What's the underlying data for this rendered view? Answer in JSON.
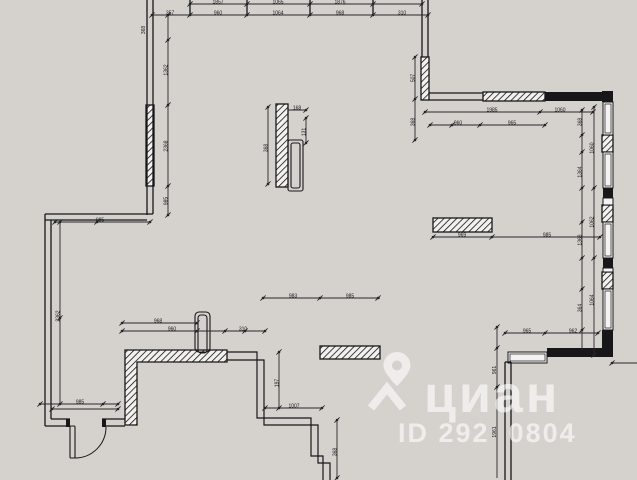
{
  "canvas": {
    "width": 637,
    "height": 480,
    "background": "#d5d2cd",
    "ink": "#17171a",
    "dim_color": "#26262a",
    "hatch_fill": "#f2f1ee",
    "window_fill": "#f4f3f1"
  },
  "watermark": {
    "logo_text": "циан",
    "id_text": "ID 292  0804",
    "color": "#ffffff",
    "pin_icon": "location-pin"
  },
  "plan": {
    "hatch_rects": [
      {
        "x": 146,
        "y": 105,
        "w": 8,
        "h": 81
      },
      {
        "x": 421,
        "y": 57,
        "w": 8,
        "h": 43
      },
      {
        "x": 483,
        "y": 92,
        "w": 62,
        "h": 9
      },
      {
        "x": 602,
        "y": 135,
        "w": 11,
        "h": 17
      },
      {
        "x": 602,
        "y": 205,
        "w": 11,
        "h": 17
      },
      {
        "x": 602,
        "y": 272,
        "w": 11,
        "h": 17
      },
      {
        "x": 276,
        "y": 104,
        "w": 12,
        "h": 83
      },
      {
        "x": 433,
        "y": 218,
        "w": 59,
        "h": 14
      },
      {
        "x": 320,
        "y": 346,
        "w": 60,
        "h": 13
      }
    ],
    "hatch_polygons": [
      {
        "pts": [
          [
            125,
            350
          ],
          [
            227,
            350
          ],
          [
            227,
            362
          ],
          [
            137,
            362
          ],
          [
            137,
            425
          ],
          [
            125,
            425
          ]
        ]
      }
    ],
    "solid_rects": [
      {
        "x": 545,
        "y": 92,
        "w": 62,
        "h": 9
      },
      {
        "x": 602,
        "y": 91,
        "w": 11,
        "h": 11
      },
      {
        "x": 603,
        "y": 188,
        "w": 10,
        "h": 10
      },
      {
        "x": 603,
        "y": 258,
        "w": 10,
        "h": 10
      },
      {
        "x": 602,
        "y": 330,
        "w": 11,
        "h": 27
      },
      {
        "x": 547,
        "y": 348,
        "w": 66,
        "h": 9
      },
      {
        "x": 66,
        "y": 419,
        "w": 4,
        "h": 8
      },
      {
        "x": 102,
        "y": 419,
        "w": 4,
        "h": 8
      }
    ],
    "window_rects": [
      {
        "x": 603,
        "y": 102,
        "w": 10,
        "h": 33
      },
      {
        "x": 603,
        "y": 152,
        "w": 10,
        "h": 36
      },
      {
        "x": 603,
        "y": 198,
        "w": 10,
        "h": 7
      },
      {
        "x": 603,
        "y": 222,
        "w": 10,
        "h": 36
      },
      {
        "x": 603,
        "y": 268,
        "w": 10,
        "h": 4
      },
      {
        "x": 603,
        "y": 289,
        "w": 10,
        "h": 41
      },
      {
        "x": 508,
        "y": 352,
        "w": 39,
        "h": 11
      }
    ],
    "lines": [
      [
        147,
        0,
        147,
        215
      ],
      [
        153,
        0,
        153,
        214
      ],
      [
        45,
        214,
        153,
        214
      ],
      [
        45,
        220,
        147,
        220
      ],
      [
        45,
        214,
        45,
        426
      ],
      [
        51,
        220,
        51,
        419
      ],
      [
        45,
        426,
        70,
        426
      ],
      [
        51,
        419,
        70,
        419
      ],
      [
        102,
        419,
        125,
        419
      ],
      [
        102,
        426,
        125,
        426
      ],
      [
        422,
        0,
        422,
        57
      ],
      [
        428,
        0,
        428,
        57
      ],
      [
        429,
        93,
        483,
        93
      ],
      [
        429,
        100,
        483,
        100
      ],
      [
        505,
        362,
        505,
        480
      ],
      [
        511,
        362,
        511,
        480
      ],
      [
        505,
        362,
        511,
        362
      ],
      [
        190,
        0,
        190,
        15
      ],
      [
        247,
        0,
        247,
        15
      ],
      [
        310,
        0,
        310,
        15
      ],
      [
        373,
        0,
        373,
        15
      ]
    ],
    "polylines": [
      {
        "pts": [
          [
            227,
            352
          ],
          [
            257,
            352
          ],
          [
            257,
            418
          ],
          [
            311,
            418
          ],
          [
            311,
            456
          ],
          [
            323,
            456
          ],
          [
            323,
            480
          ]
        ]
      },
      {
        "pts": [
          [
            227,
            360
          ],
          [
            264,
            360
          ],
          [
            264,
            425
          ],
          [
            318,
            425
          ],
          [
            318,
            463
          ],
          [
            330,
            463
          ],
          [
            330,
            480
          ]
        ]
      }
    ],
    "stroke_rects": [
      {
        "x": 195,
        "y": 312,
        "w": 15,
        "h": 40,
        "rx": 4,
        "name": "stub-wall"
      },
      {
        "x": 198,
        "y": 315,
        "w": 9,
        "h": 38,
        "rx": 3,
        "name": "stub-wall-inner"
      },
      {
        "x": 288,
        "y": 140,
        "w": 15,
        "h": 51,
        "rx": 2,
        "name": "duct-shaft"
      },
      {
        "x": 291,
        "y": 143,
        "w": 9,
        "h": 45,
        "rx": 2,
        "name": "duct-shaft-inner"
      },
      {
        "x": 70,
        "y": 426,
        "w": 5,
        "h": 32,
        "rx": 1,
        "name": "door-leaf"
      }
    ],
    "door_arc": {
      "d": "M 75 458 A 31 31 0 0 0 106 427"
    },
    "dim_lines": [
      {
        "x1": 190,
        "y1": 4,
        "x2": 422,
        "y2": 4,
        "ticks": [
          190,
          247,
          310,
          373,
          422
        ]
      },
      {
        "x1": 152,
        "y1": 15,
        "x2": 428,
        "y2": 15,
        "ticks": [
          152,
          190,
          247,
          310,
          373,
          428
        ]
      },
      {
        "x1": 168,
        "y1": 15,
        "x2": 168,
        "y2": 215,
        "ticks": [
          15,
          40,
          105,
          186,
          215
        ]
      },
      {
        "x1": 55,
        "y1": 222,
        "x2": 150,
        "y2": 222,
        "ticks": [
          55,
          97,
          150
        ]
      },
      {
        "x1": 60,
        "y1": 222,
        "x2": 60,
        "y2": 404,
        "ticks": [
          222,
          318,
          404
        ]
      },
      {
        "x1": 40,
        "y1": 404,
        "x2": 118,
        "y2": 404,
        "ticks": [
          40,
          103,
          118
        ]
      },
      {
        "x1": 52,
        "y1": 409,
        "x2": 118,
        "y2": 409,
        "ticks": [
          52,
          118
        ]
      },
      {
        "x1": 122,
        "y1": 323,
        "x2": 197,
        "y2": 323,
        "ticks": [
          122,
          197
        ]
      },
      {
        "x1": 122,
        "y1": 331,
        "x2": 265,
        "y2": 331,
        "ticks": [
          122,
          197,
          225,
          245,
          265
        ]
      },
      {
        "x1": 263,
        "y1": 298,
        "x2": 380,
        "y2": 298,
        "ticks": [
          263,
          320,
          378
        ]
      },
      {
        "x1": 433,
        "y1": 237,
        "x2": 600,
        "y2": 237,
        "ticks": [
          433,
          492,
          600
        ]
      },
      {
        "x1": 425,
        "y1": 112,
        "x2": 593,
        "y2": 112,
        "ticks": [
          425,
          540,
          593
        ]
      },
      {
        "x1": 430,
        "y1": 125,
        "x2": 545,
        "y2": 125,
        "ticks": [
          430,
          452,
          480,
          545
        ]
      },
      {
        "x1": 415,
        "y1": 57,
        "x2": 415,
        "y2": 140,
        "ticks": [
          57,
          99,
          140
        ]
      },
      {
        "x1": 582,
        "y1": 110,
        "x2": 582,
        "y2": 350,
        "ticks": [
          110,
          135,
          152,
          188,
          222,
          258,
          289,
          330
        ]
      },
      {
        "x1": 594,
        "y1": 107,
        "x2": 594,
        "y2": 355,
        "ticks": [
          107,
          188,
          258,
          355
        ]
      },
      {
        "x1": 505,
        "y1": 333,
        "x2": 598,
        "y2": 333,
        "ticks": [
          505,
          545,
          598
        ]
      },
      {
        "x1": 497,
        "y1": 327,
        "x2": 497,
        "y2": 478,
        "ticks": [
          327,
          348,
          387
        ]
      },
      {
        "x1": 612,
        "y1": 363,
        "x2": 637,
        "y2": 363,
        "ticks": [
          612
        ]
      },
      {
        "x1": 279,
        "y1": 352,
        "x2": 279,
        "y2": 408,
        "ticks": [
          352,
          408
        ]
      },
      {
        "x1": 265,
        "y1": 408,
        "x2": 322,
        "y2": 408,
        "ticks": [
          265,
          322
        ]
      },
      {
        "x1": 337,
        "y1": 420,
        "x2": 337,
        "y2": 478,
        "ticks": [
          420,
          478
        ]
      },
      {
        "x1": 268,
        "y1": 107,
        "x2": 268,
        "y2": 184,
        "ticks": [
          107,
          184
        ]
      },
      {
        "x1": 306,
        "y1": 118,
        "x2": 306,
        "y2": 143,
        "ticks": [
          118,
          143
        ]
      },
      {
        "x1": 288,
        "y1": 110,
        "x2": 306,
        "y2": 110,
        "ticks": [
          306
        ]
      }
    ],
    "dim_texts": [
      {
        "x": 218,
        "y": 2.5,
        "t": "1857"
      },
      {
        "x": 278,
        "y": 2.5,
        "t": "1065"
      },
      {
        "x": 340,
        "y": 2.5,
        "t": "1876"
      },
      {
        "x": 170,
        "y": 13.5,
        "t": "357"
      },
      {
        "x": 218,
        "y": 13.5,
        "t": "960"
      },
      {
        "x": 278,
        "y": 13.5,
        "t": "1064"
      },
      {
        "x": 340,
        "y": 13.5,
        "t": "968"
      },
      {
        "x": 402,
        "y": 13.5,
        "t": "310"
      },
      {
        "x": 166.5,
        "y": 70,
        "t": "1362",
        "rot": 1
      },
      {
        "x": 166.5,
        "y": 146,
        "t": "2368",
        "rot": 1
      },
      {
        "x": 166.5,
        "y": 201,
        "t": "985",
        "rot": 1
      },
      {
        "x": 144,
        "y": 30,
        "t": "368",
        "rot": 1
      },
      {
        "x": 100,
        "y": 220.5,
        "t": "985"
      },
      {
        "x": 58.5,
        "y": 316,
        "t": "2362",
        "rot": 1
      },
      {
        "x": 80,
        "y": 402.5,
        "t": "985"
      },
      {
        "x": 158,
        "y": 321.5,
        "t": "968"
      },
      {
        "x": 172,
        "y": 329.5,
        "t": "960"
      },
      {
        "x": 243,
        "y": 329.5,
        "t": "310"
      },
      {
        "x": 293,
        "y": 296.5,
        "t": "983"
      },
      {
        "x": 350,
        "y": 296.5,
        "t": "985"
      },
      {
        "x": 462,
        "y": 235.5,
        "t": "969"
      },
      {
        "x": 547,
        "y": 235.5,
        "t": "985"
      },
      {
        "x": 492,
        "y": 110.5,
        "t": "1985"
      },
      {
        "x": 560,
        "y": 110.5,
        "t": "1060"
      },
      {
        "x": 458,
        "y": 123.5,
        "t": "960"
      },
      {
        "x": 512,
        "y": 123.5,
        "t": "965"
      },
      {
        "x": 413.5,
        "y": 78,
        "t": "507",
        "rot": 1
      },
      {
        "x": 413.5,
        "y": 122,
        "t": "368",
        "rot": 1
      },
      {
        "x": 580.5,
        "y": 122,
        "t": "368",
        "rot": 1
      },
      {
        "x": 580.5,
        "y": 172,
        "t": "1364",
        "rot": 1
      },
      {
        "x": 580.5,
        "y": 240,
        "t": "1368",
        "rot": 1
      },
      {
        "x": 580.5,
        "y": 308,
        "t": "364",
        "rot": 1
      },
      {
        "x": 592.5,
        "y": 148,
        "t": "1060",
        "rot": 1
      },
      {
        "x": 592.5,
        "y": 222,
        "t": "1062",
        "rot": 1
      },
      {
        "x": 592.5,
        "y": 300,
        "t": "1064",
        "rot": 1
      },
      {
        "x": 527,
        "y": 331.5,
        "t": "965"
      },
      {
        "x": 573,
        "y": 331.5,
        "t": "962"
      },
      {
        "x": 495,
        "y": 370,
        "t": "961",
        "rot": 1
      },
      {
        "x": 495,
        "y": 432,
        "t": "1961",
        "rot": 1
      },
      {
        "x": 277.5,
        "y": 383,
        "t": "197",
        "rot": 1
      },
      {
        "x": 294,
        "y": 406.5,
        "t": "1007"
      },
      {
        "x": 335.5,
        "y": 452,
        "t": "368",
        "rot": 1
      },
      {
        "x": 266.5,
        "y": 148,
        "t": "368",
        "rot": 1
      },
      {
        "x": 304.5,
        "y": 132,
        "t": "131",
        "rot": 1
      },
      {
        "x": 297,
        "y": 108.5,
        "t": "168"
      }
    ]
  }
}
